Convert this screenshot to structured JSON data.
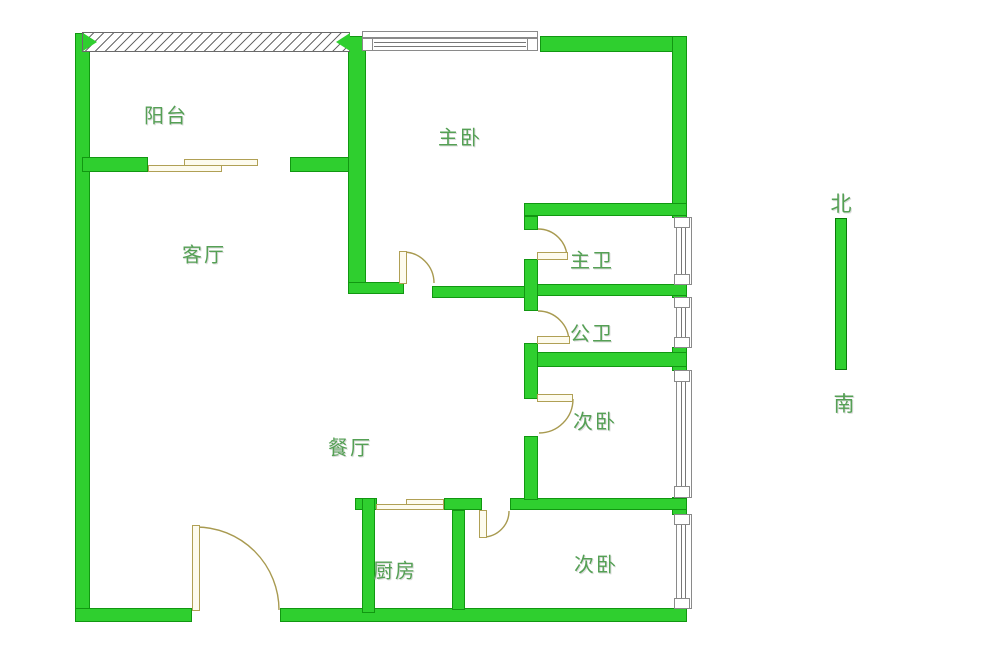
{
  "rooms": {
    "balcony": "阳台",
    "master_bedroom": "主卧",
    "living_room": "客厅",
    "master_bathroom": "主卫",
    "shared_bathroom": "公卫",
    "second_bedroom_middle": "次卧",
    "dining_room": "餐厅",
    "kitchen": "厨房",
    "second_bedroom_bottom": "次卧"
  },
  "compass": {
    "north": "北",
    "south": "南"
  },
  "colors": {
    "wall_fill": "#2fcf2f",
    "wall_outline": "#119711",
    "room_label": "#55a055",
    "door": "#b0a055",
    "window_outline": "#8a8a8a",
    "background": "#ffffff"
  }
}
